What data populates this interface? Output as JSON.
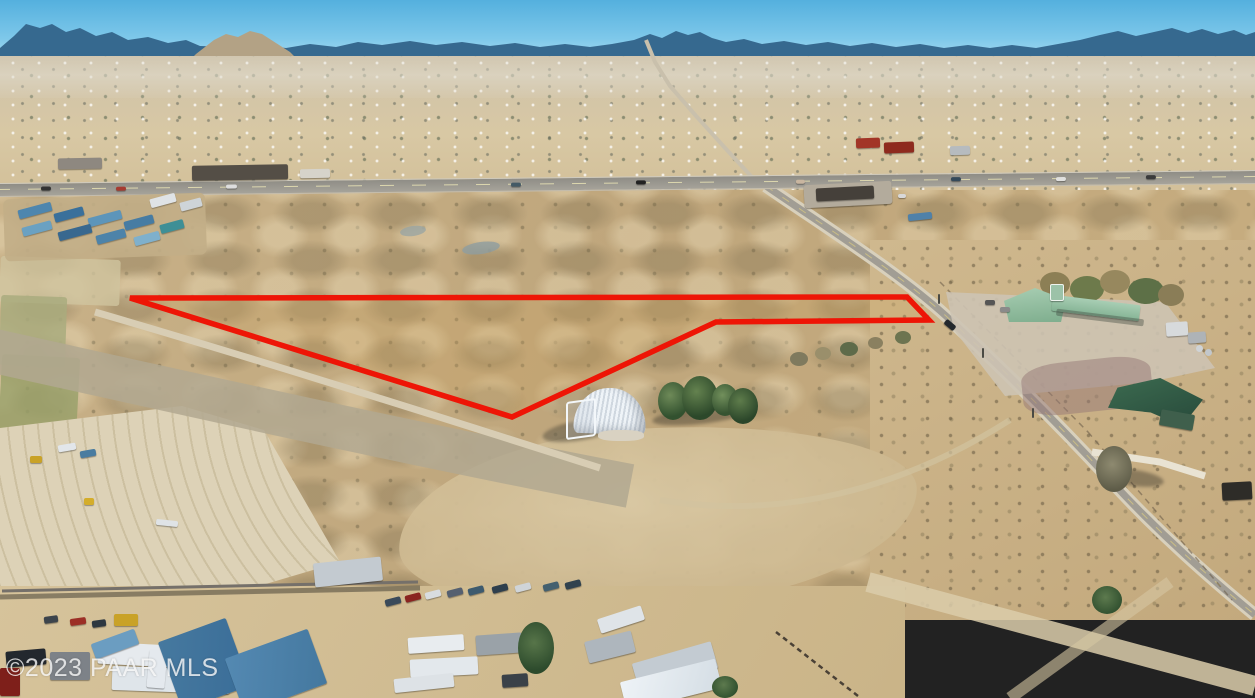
{
  "scene": {
    "type": "aerial drone photograph",
    "subject": "vacant high-desert land parcel marked with a red boundary outline",
    "landmarks": [
      "mountain range on horizon",
      "desert town sprawl",
      "highway with T-intersection",
      "paved side road to bottom right",
      "white quonset-hut building",
      "juniper tree cluster",
      "green-roofed ranch house complex",
      "truck container yard",
      "RV and warehouse yards"
    ]
  },
  "watermark": {
    "text": "©2023 PAAR MLS"
  },
  "property_outline": {
    "points": "130,298 907,297 929,320 716,322 512,417",
    "color": "#ee1506",
    "width": "5.5"
  },
  "palette": {
    "sky_top": "#54b0de",
    "sky_horizon": "#b9e4f3",
    "mountains_blue": "#36698f",
    "butte_tan": "#b3a285",
    "valley_floor": "#d5c6a6",
    "pasture_tan": "#c3ab80",
    "lot_gold": "#cea45c",
    "bright_dirt": "#ddd2b7",
    "asphalt_gray": "#a19d94",
    "quonset_white": "#eff4f8",
    "tree_green": "#32512f",
    "roof_sage_green": "#9cc2a8",
    "roof_dark_green": "#33604a",
    "container_blue": "#4c84ac",
    "outline_red": "#ee1506",
    "watermark_white": "#ffffff"
  }
}
